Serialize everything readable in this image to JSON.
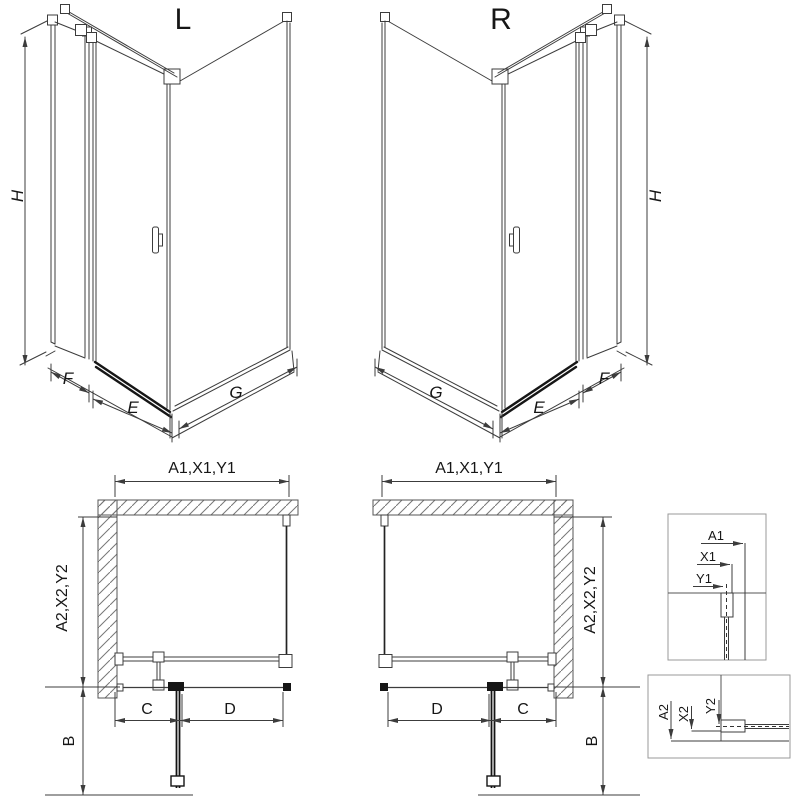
{
  "labels": {
    "variant_left": "L",
    "variant_right": "R",
    "height": "H",
    "return_panel": "F",
    "door_width": "E",
    "side_panel": "G",
    "width_group": "A1,X1,Y1",
    "depth_group": "A2,X2,Y2",
    "fixed_segment": "C",
    "door_segment": "D",
    "door_swing": "B",
    "detail": {
      "a1": "A1",
      "x1": "X1",
      "y1": "Y1",
      "a2": "A2",
      "x2": "X2",
      "y2": "Y2"
    }
  },
  "colors": {
    "background": "#ffffff",
    "line": "#3c3c3c",
    "dark_profile": "#161616",
    "wall_hatch": "#777777",
    "detail_box_border": "#999999"
  }
}
